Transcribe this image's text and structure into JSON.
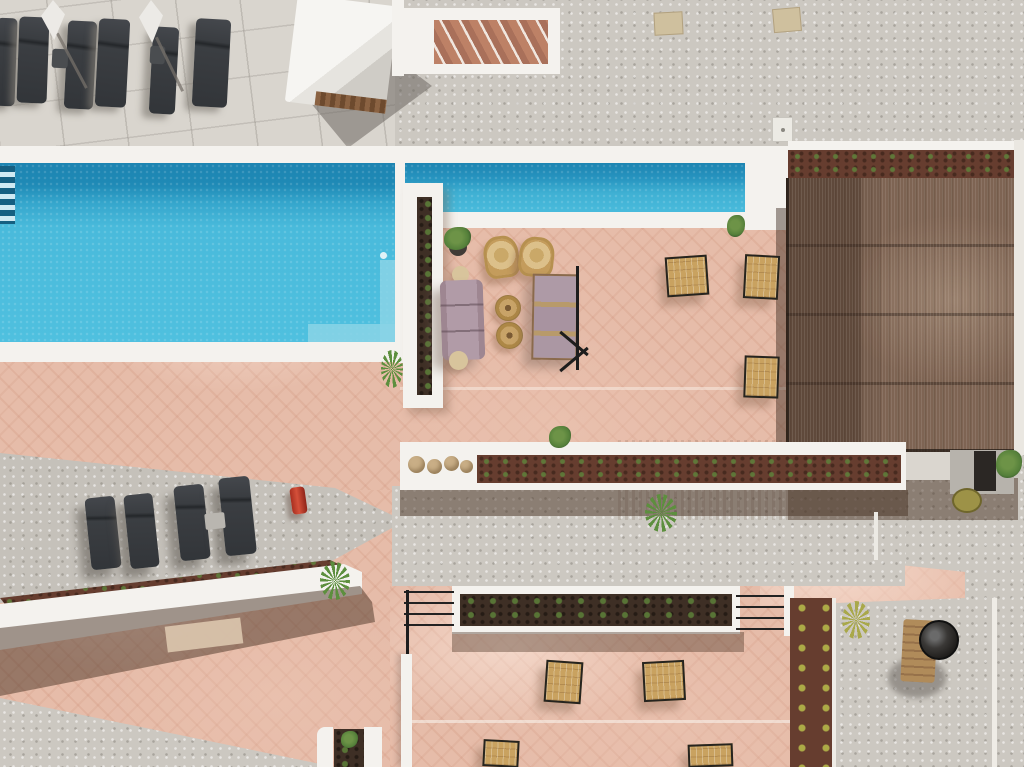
{
  "scene": {
    "type": "aerial-photo",
    "description": "Aerial drone view of a villa pool deck: long turquoise lap pool, white coping, terracotta terraces, reed pergola, sun loungers, planters and barbecue area",
    "labels": {
      "stone_pavement": "stone-tiled sun deck",
      "gravel_area": "gravel ground",
      "terracotta_terrace": "terracotta tiled terrace",
      "pool": "swimming pool",
      "pool_lane": "pool lap lane",
      "pool_ladder": "pool ladder",
      "pool_steps": "submerged pool bench",
      "sun_lounger": "sun lounger",
      "umbrella": "folded parasol",
      "cabana": "white day-bed cabana",
      "stairs": "outdoor staircase",
      "service_hatch": "service hatch",
      "pergola": "reed pergola roof",
      "pergola_planter": "pergola edge planter",
      "white_planter_wall": "white planter wall",
      "long_planter": "succulent planter wall",
      "decorative_stones": "decorative stones",
      "lower_planter": "flower bed planter",
      "railing": "metal railing",
      "seating_area": "lounge seating area",
      "sofa": "outdoor sofa",
      "daybed": "double sun bed",
      "wicker_chair": "wicker armchair",
      "drum_table": "wicker drum table",
      "side_table": "side table",
      "dining_table": "bistro table set",
      "potted_plant": "potted plant",
      "plant": "plant",
      "bar_counter": "bar counter",
      "bar_stool": "bar stool",
      "outdoor_kitchen": "outdoor kitchen unit",
      "fire_extinguisher": "fire extinguisher",
      "planter_bed": "planting bed",
      "bbq": "kettle barbecue grill",
      "white_wall": "low white wall"
    }
  },
  "colors": {
    "pavement": "#d9d5ce",
    "gravel": "#ccc8c1",
    "gravel_dark": "#c5c1ba",
    "coping": "#f4f2ee",
    "terracotta": "#e6bca9",
    "water": "#4cbdde",
    "water_deep": "#1d84b1",
    "water_step": "#8ad4e6",
    "pergola_wood": "#7e6453",
    "soil": "#663d2f",
    "soil_dark": "#3e2f25",
    "plant_green": "#5d7f3f",
    "plant_yellow": "#a9a84a",
    "wood": "#c9a260",
    "wicker": "#d4b67c",
    "lounger_dark": "#393c3f",
    "mauve": "#b19ba7",
    "red_accent": "#c23a28",
    "stone_ball": "#c9ae86"
  }
}
